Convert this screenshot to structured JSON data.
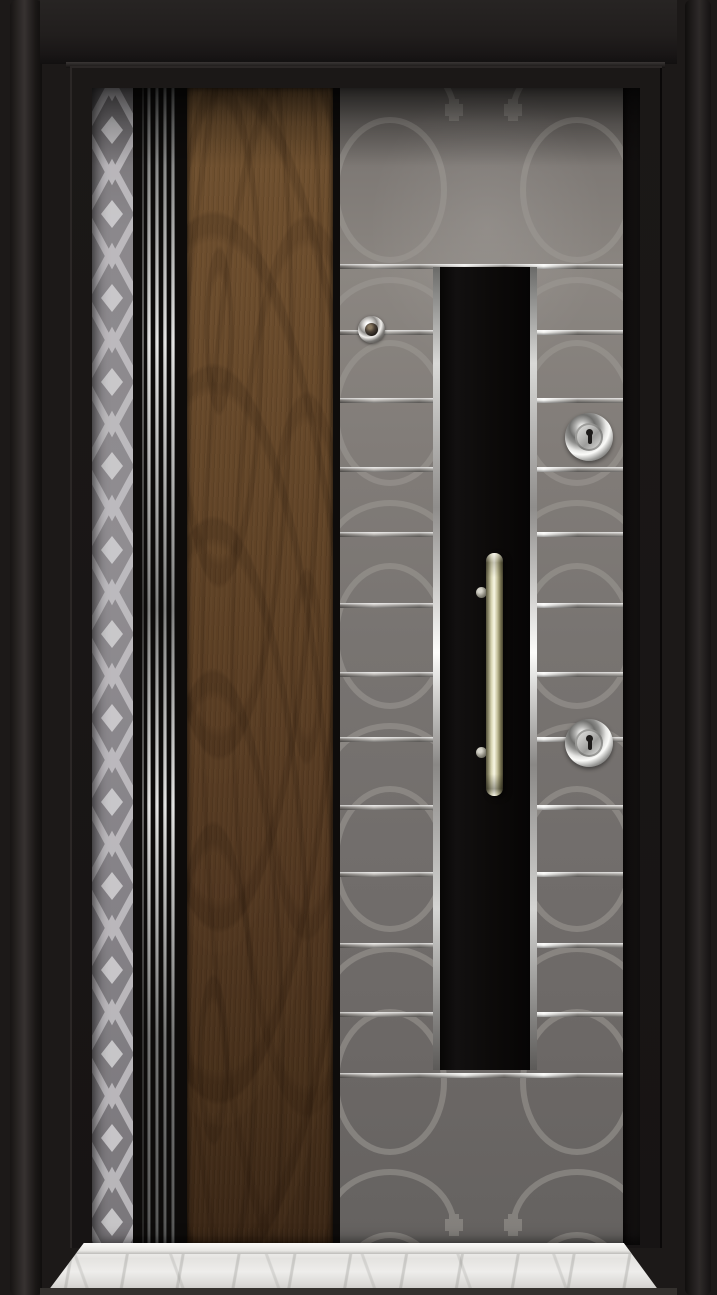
{
  "scene": {
    "subject": "steel-security-door-product-photo",
    "view": "front",
    "text_content": []
  },
  "palette": {
    "frame_black": "#1c1918",
    "leaf_black": "#0e0c0b",
    "gray_light": "#8b8681",
    "gray_mid": "#787471",
    "gray_dark": "#656260",
    "pattern_line": "#999591",
    "diamond_line": "#c9c7ca",
    "diamond_fill": "#d4d2d5",
    "wood_light": "#70512f",
    "wood_mid": "#5e4125",
    "wood_dark": "#3a2615",
    "chrome_bright": "#fdfdfb",
    "chrome_mid": "#8f8d8b",
    "brass_light": "#f7f5e4",
    "brass_dark": "#55523c",
    "marble_light": "#f7f6f4",
    "marble_mid": "#dcdbd8"
  },
  "door": {
    "stripe_group": {
      "lines": [
        {
          "x": 9,
          "w": 2,
          "bright": false
        },
        {
          "x": 14,
          "w": 4,
          "bright": true
        },
        {
          "x": 22,
          "w": 4,
          "bright": true
        },
        {
          "x": 30,
          "w": 4,
          "bright": true
        },
        {
          "x": 38,
          "w": 4,
          "bright": true
        }
      ]
    },
    "gray_panel": {
      "strips_y": [
        176,
        242,
        310,
        379,
        444,
        515,
        584,
        649,
        717,
        784,
        855,
        924,
        985
      ]
    },
    "hardware": {
      "peephole": {
        "cx": 31,
        "cy": 241,
        "d": 27
      },
      "locks": [
        {
          "id": "lock-cylinder-upper",
          "cx": 249,
          "cy": 349,
          "d": 48
        },
        {
          "id": "lock-cylinder-lower",
          "cx": 249,
          "cy": 655,
          "d": 48
        }
      ],
      "handle": {
        "x": 146,
        "y": 465,
        "w": 17,
        "h": 243,
        "mounts_cy": [
          504,
          664
        ],
        "mount_cx": 141,
        "mount_d": 11
      }
    }
  }
}
